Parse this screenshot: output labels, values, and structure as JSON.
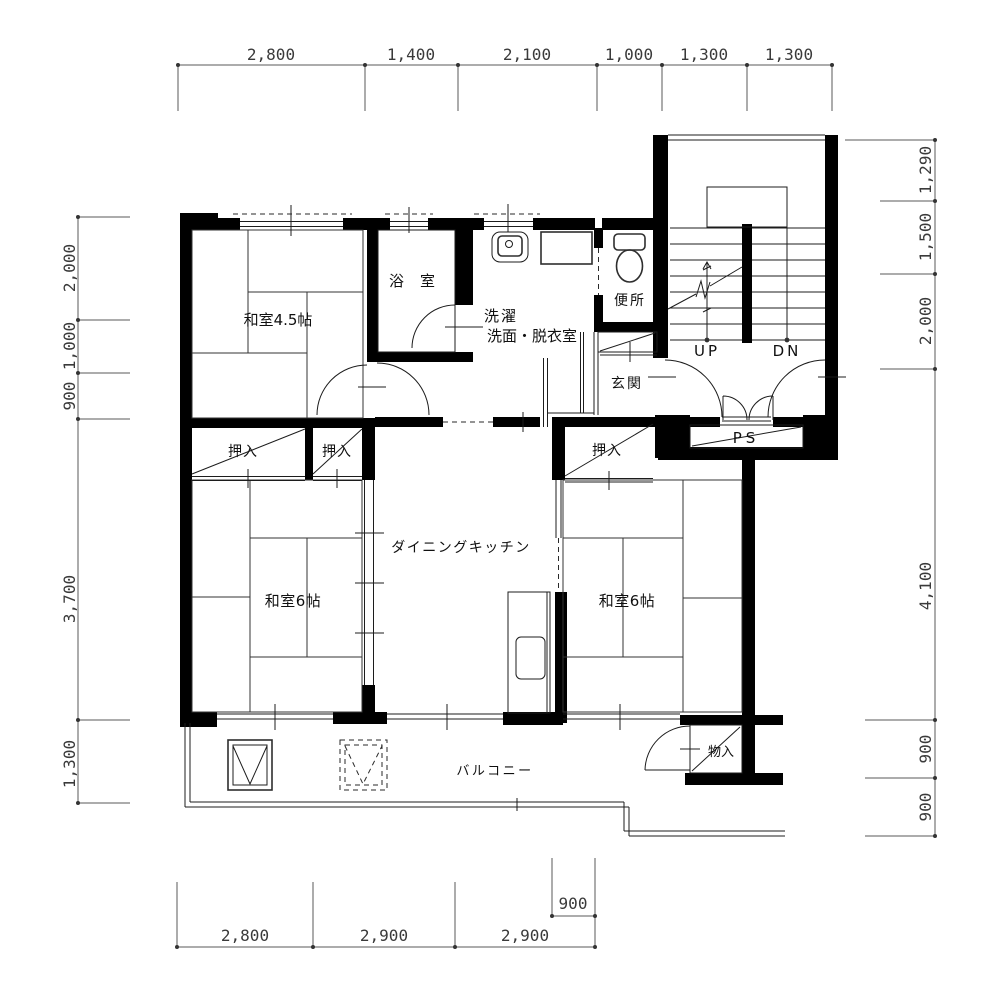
{
  "rooms": {
    "washitsu45": "和室4.5帖",
    "washitsu6_left": "和室6帖",
    "washitsu6_right": "和室6帖",
    "dk": "ダイニングキッチン",
    "bath": "浴室",
    "laundry_line1": "洗濯",
    "laundry_line2": "洗面・脱衣室",
    "toilet": "便所",
    "genkan": "玄関",
    "oshiire": "押入",
    "monoire": "物入",
    "balcony": "バルコニー",
    "ps": "PS",
    "up": "UP",
    "dn": "DN"
  },
  "dims": {
    "top": [
      "2,800",
      "1,400",
      "2,100",
      "1,000",
      "1,300",
      "1,300"
    ],
    "left": [
      "2,000",
      "1,000",
      "900",
      "3,700",
      "1,300"
    ],
    "right": [
      "1,290",
      "1,500",
      "2,000",
      "4,100",
      "900",
      "900"
    ],
    "bottom": [
      "2,800",
      "2,900",
      "2,900"
    ],
    "bottom_extra": "900"
  },
  "colors": {
    "wall": "#000000",
    "line": "#2e2e2e",
    "dimension": "#5a5a5a",
    "background": "#ffffff"
  }
}
